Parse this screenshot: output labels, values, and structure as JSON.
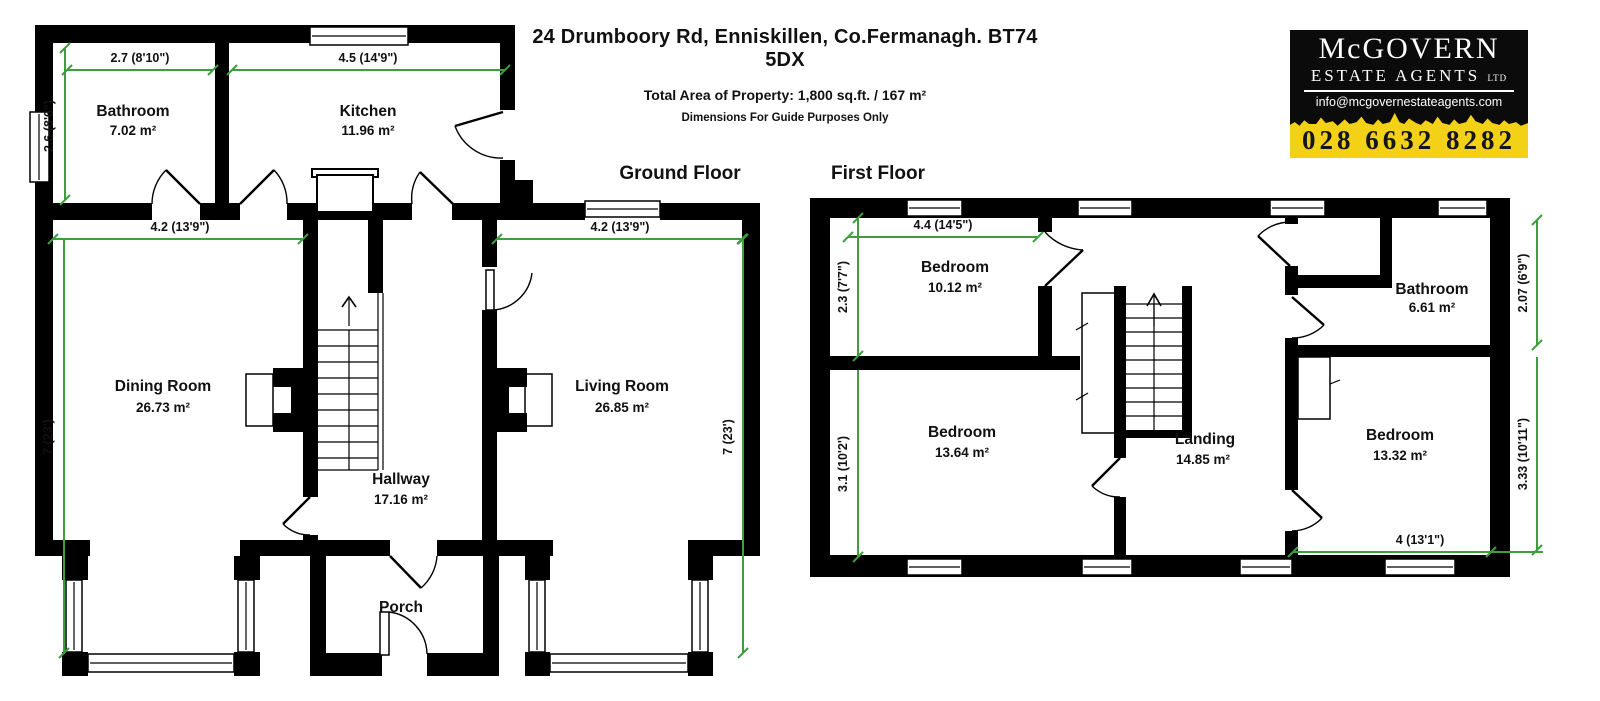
{
  "header": {
    "address": "24 Drumboory Rd, Enniskillen, Co.Fermanagh. BT74 5DX",
    "total_area": "Total Area of Property: 1,800 sq.ft. / 167 m²",
    "disclaimer": "Dimensions For Guide Purposes Only"
  },
  "logo": {
    "name": "McGOVERN",
    "subtitle": "ESTATE AGENTS ",
    "subtitle_suffix": "LTD",
    "email": "info@mcgovernestateagents.com",
    "phone": "028 6632 8282",
    "colors": {
      "background": "#0b0b0b",
      "band": "#f3d117",
      "text": "#ffffff"
    }
  },
  "plan_colors": {
    "walls": "#000000",
    "dimension_lines": "#3e9e3e"
  },
  "floors": {
    "ground": {
      "title": "Ground Floor",
      "rooms": [
        {
          "name": "Bathroom",
          "area": "7.02 m²"
        },
        {
          "name": "Kitchen",
          "area": "11.96 m²"
        },
        {
          "name": "Dining Room",
          "area": "26.73 m²"
        },
        {
          "name": "Living Room",
          "area": "26.85 m²"
        },
        {
          "name": "Hallway",
          "area": "17.16 m²"
        },
        {
          "name": "Porch",
          "area": ""
        }
      ],
      "dims": [
        "2.7 (8'10\")",
        "4.5 (14'9\")",
        "2.6 (8'6\")",
        "4.2 (13'9\")",
        "4.2 (13'9\")",
        "7 (23')",
        "7 (23')"
      ]
    },
    "first": {
      "title": "First Floor",
      "rooms": [
        {
          "name": "Bedroom",
          "area": "10.12 m²"
        },
        {
          "name": "Bathroom",
          "area": "6.61 m²"
        },
        {
          "name": "Bedroom",
          "area": "13.64 m²"
        },
        {
          "name": "Landing",
          "area": "14.85 m²"
        },
        {
          "name": "Bedroom",
          "area": "13.32 m²"
        }
      ],
      "dims": [
        "4.4 (14'5\")",
        "2.3 (7'7\")",
        "3.1 (10'2')",
        "2.07 (6'9\")",
        "3.33 (10'11\")",
        "4 (13'1\")"
      ]
    }
  }
}
